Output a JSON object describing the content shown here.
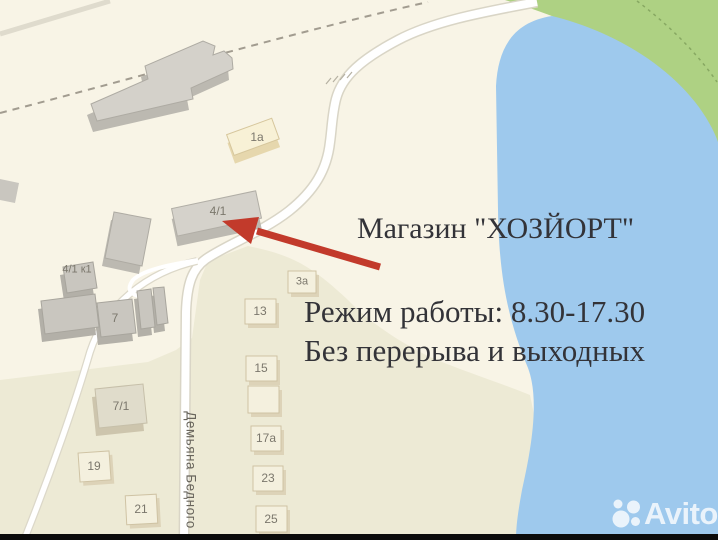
{
  "annotation": {
    "title": "Магазин \"ХОЗЙОРТ\"",
    "schedule_line1": "Режим работы: 8.30-17.30",
    "schedule_line2": "Без перерыва и выходных"
  },
  "map": {
    "street": "Демьяна Бедного",
    "buildings": {
      "b_1a": "1а",
      "b_41": "4/1",
      "b_41k1": "4/1 к1",
      "b_7": "7",
      "b_3a": "3а",
      "b_13": "13",
      "b_71": "7/1",
      "b_15": "15",
      "b_17a": "17а",
      "b_19": "19",
      "b_21": "21",
      "b_23": "23",
      "b_25": "25"
    }
  },
  "watermark": {
    "brand": "Avito"
  },
  "colors": {
    "land": "#f8f4e6",
    "district": "#edead5",
    "water": "#9ec9ed",
    "green": "#aed183",
    "road": "#ffffff",
    "building_gray": "#d4d1ca",
    "building_beige": "#f6efd5",
    "arrow_red": "#c23a2b",
    "annotation_text": "#333338"
  }
}
